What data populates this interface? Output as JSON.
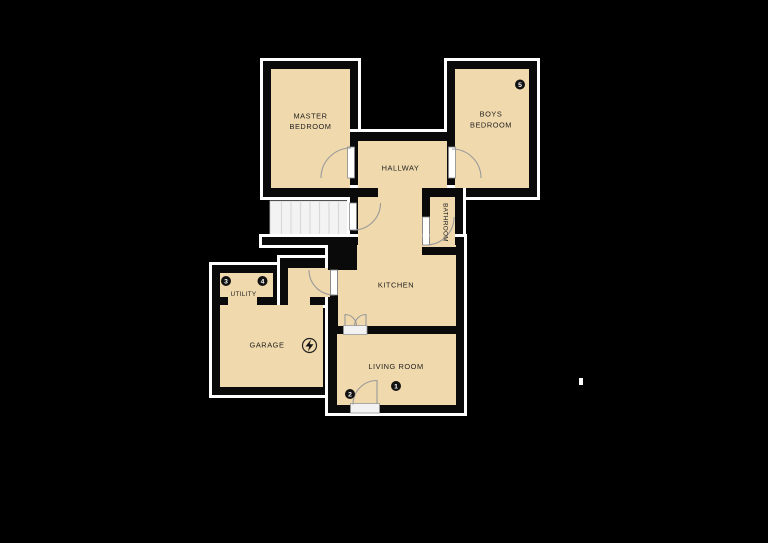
{
  "figure_type": "floor-plan",
  "background_color": "#000000",
  "colors": {
    "room_fill": "#F0D9AC",
    "walls": "#0A0A0A",
    "outer_outline": "#FFFFFF",
    "stairs_fill": "#F3F3F3",
    "stair_tread_lines": "#D9D9D9",
    "door_arc": "#9A9A9A",
    "door_leaf": "#FFFFFF",
    "badge_background": "#111111",
    "badge_text": "#FFFFFF",
    "label_text": "#1E1E1E"
  },
  "rooms": [
    {
      "name": "Master Bedroom",
      "label_lines": [
        "MASTER",
        "BEDROOM"
      ]
    },
    {
      "name": "Boys Bedroom",
      "label_lines": [
        "BOYS",
        "BEDROOM"
      ],
      "badges": [
        "5"
      ]
    },
    {
      "name": "Hallway",
      "label_lines": [
        "HALLWAY"
      ]
    },
    {
      "name": "Bathroom",
      "label_lines": [
        "BATHROOM"
      ],
      "label_rotated_90": true
    },
    {
      "name": "Kitchen",
      "label_lines": [
        "KITCHEN"
      ]
    },
    {
      "name": "Utility",
      "label_lines": [
        "UTILITY"
      ],
      "badges": [
        "3",
        "4"
      ]
    },
    {
      "name": "Garage",
      "label_lines": [
        "GARAGE"
      ],
      "features": [
        "electrical-icon"
      ]
    },
    {
      "name": "Living Room",
      "label_lines": [
        "LIVING ROOM"
      ],
      "badges": [
        "1",
        "2"
      ]
    }
  ],
  "markers": [
    {
      "number": "1",
      "room": "Living Room"
    },
    {
      "number": "2",
      "room": "Living Room"
    },
    {
      "number": "3",
      "room": "Utility"
    },
    {
      "number": "4",
      "room": "Utility"
    },
    {
      "number": "5",
      "room": "Boys Bedroom"
    }
  ],
  "features": {
    "stairs": "staircase with treads beside hallway landing",
    "doors": [
      "master-bedroom-door",
      "boys-bedroom-door",
      "landing-stairs-door",
      "bathroom-door",
      "kitchen-lobby-door",
      "kitchen-living-double-door",
      "living-room-entrance-door"
    ]
  }
}
